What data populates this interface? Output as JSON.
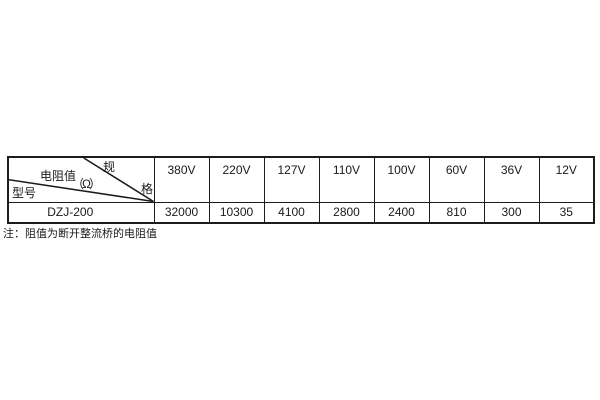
{
  "table": {
    "corner": {
      "spec_top": "规",
      "spec_bottom": "格",
      "resistance_label": "电阻值",
      "resistance_unit": "（Ω）",
      "model_label": "型号"
    },
    "voltage_headers": [
      "380V",
      "220V",
      "127V",
      "110V",
      "100V",
      "60V",
      "36V",
      "12V"
    ],
    "row": {
      "model": "DZJ-200",
      "values": [
        "32000",
        "10300",
        "4100",
        "2800",
        "2400",
        "810",
        "300",
        "35"
      ]
    }
  },
  "note": "注：阻值为断开整流桥的电阻值",
  "colors": {
    "border": "#1c1c1c",
    "text": "#1a1a1a",
    "background": "#ffffff"
  }
}
